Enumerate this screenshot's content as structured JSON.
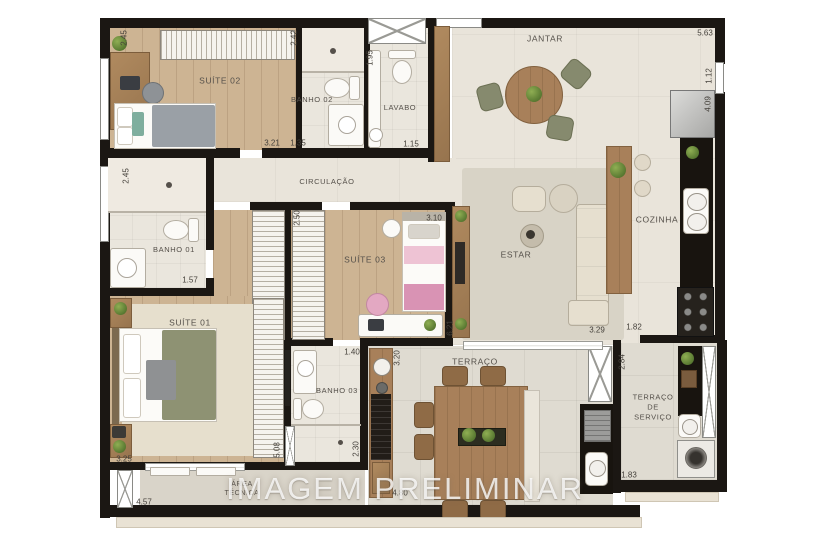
{
  "watermark": "IMAGEM PRELIMINAR",
  "rooms": {
    "suite02": "SUÍTE 02",
    "banho02": "BANHO 02",
    "lavabo": "LAVABO",
    "jantar": "JANTAR",
    "circulacao": "CIRCULAÇÃO",
    "banho01": "BANHO 01",
    "suite03": "SUÍTE 03",
    "estar": "ESTAR",
    "cozinha": "COZINHA",
    "suite01": "SUÍTE 01",
    "banho03": "BANHO 03",
    "terraco": "TERRAÇO",
    "terraco_servico": "TERRAÇO\nDE\nSERVIÇO",
    "area_tecnica": "ÁREA\nTÉCNICA"
  },
  "dims": {
    "suite02_h": "2.45",
    "banho02_h": "2.42",
    "lavabo_h": "1.95",
    "suite02_w": "3.21",
    "banho02_w": "1.35",
    "lavabo_w": "1.15",
    "jantar_w": "5.63",
    "janela_direita": "1.12",
    "cozinha_h": "4.09",
    "banho01_h": "2.45",
    "banho01_w": "1.57",
    "closet_h": "2.50",
    "suite03_w": "3.10",
    "estar_h": "6.21",
    "banho03_w": "1.40",
    "terraco_h": "3.20",
    "banho03_h": "2.30",
    "suite01_w": "3.25",
    "suite01_h": "5.08",
    "area_tecnica_w": "4.57",
    "terraco_w": "4.80",
    "estar_w": "3.29",
    "cozinha_w": "1.82",
    "servico_h": "2.84",
    "servico_w": "1.83"
  },
  "colors": {
    "walls": "#1b1713",
    "wood_floor": "#cdb493",
    "tile_floor": "#e9e4da",
    "black_counter": "#18140f",
    "accent_pink": "#d993b4",
    "accent_olive": "#8e9273",
    "plant_green": "#6f9b44"
  }
}
